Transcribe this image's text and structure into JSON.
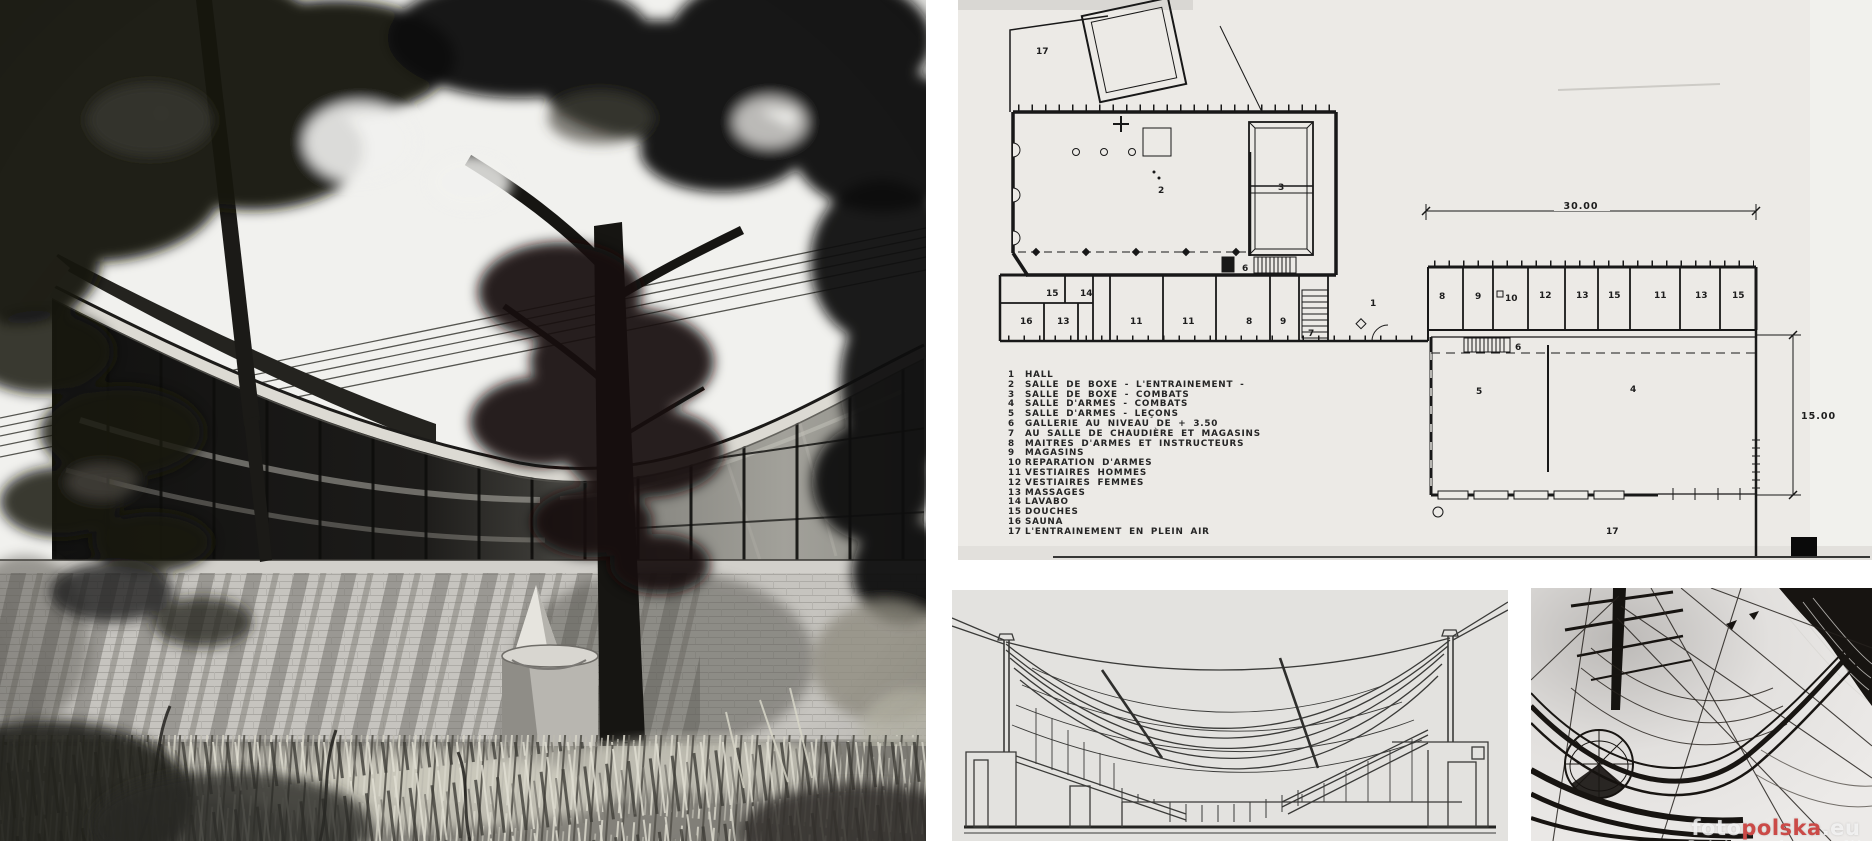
{
  "plan": {
    "legend": [
      {
        "num": "1",
        "label": "HALL"
      },
      {
        "num": "2",
        "label": "SALLE DE BOXE - L'ENTRAINEMENT -"
      },
      {
        "num": "3",
        "label": "SALLE DE BOXE - COMBATS"
      },
      {
        "num": "4",
        "label": "SALLE D'ARMES - COMBATS"
      },
      {
        "num": "5",
        "label": "SALLE D'ARMES - LEÇONS"
      },
      {
        "num": "6",
        "label": "GALLERIE AU NIVEAU DE + 3.50"
      },
      {
        "num": "7",
        "label": "AU SALLE DE CHAUDIÈRE ET MAGASINS"
      },
      {
        "num": "8",
        "label": "MAITRES D'ARMES ET INSTRUCTEURS"
      },
      {
        "num": "9",
        "label": "MAGASINS"
      },
      {
        "num": "10",
        "label": "REPARATION D'ARMES"
      },
      {
        "num": "11",
        "label": "VESTIAIRES HOMMES"
      },
      {
        "num": "12",
        "label": "VESTIAIRES FEMMES"
      },
      {
        "num": "13",
        "label": "MASSAGES"
      },
      {
        "num": "14",
        "label": "LAVABO"
      },
      {
        "num": "15",
        "label": "DOUCHES"
      },
      {
        "num": "16",
        "label": "SAUNA"
      },
      {
        "num": "17",
        "label": "L'ENTRAINEMENT EN PLEIN AIR"
      }
    ],
    "dimensions": {
      "width": "30.00",
      "height": "15.00"
    },
    "rooms": {
      "outdoor_top": "17",
      "hall2": "2",
      "ring3": "3",
      "gallery6": "6",
      "strip": [
        "15",
        "14",
        "16",
        "13",
        "11",
        "11",
        "8",
        "9",
        "7",
        "1"
      ],
      "wing": [
        "8",
        "9",
        "10",
        "12",
        "13",
        "15",
        "11",
        "13",
        "15"
      ],
      "lower": [
        "6",
        "5",
        "4"
      ],
      "outdoor_bottom": "17"
    }
  },
  "watermark": {
    "foto": "foto",
    "polska": "polska",
    "eu": ".eu",
    "tagline": "Polska na fotografii"
  },
  "colors": {
    "paper_plan": "#eceae6",
    "paper_section": "#e3e2df",
    "paper_rigging": "#eceae8",
    "ink": "#181818",
    "watermark_red": "#cb4a47",
    "gap_white": "#ffffff"
  }
}
